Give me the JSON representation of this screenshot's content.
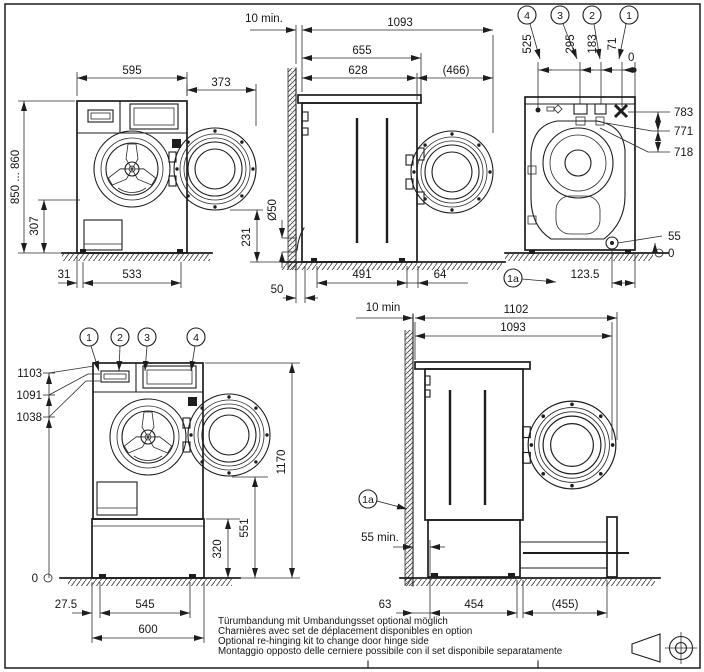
{
  "views": {
    "front_top": {
      "width": "595",
      "door_swing": "373",
      "height_range": "850 ... 860",
      "porthole_bottom": "307",
      "foot_inset": "31",
      "feet_distance": "533",
      "door_clearance": "231"
    },
    "side_top": {
      "wall_gap": "10 min.",
      "overall_depth": "1093",
      "lid_depth": "655",
      "body_depth": "628",
      "door_swing": "(466)",
      "drain_diameter": "Ø50",
      "rear_foot": "50",
      "feet_distance": "491",
      "front_overhang": "64"
    },
    "rear_top": {
      "callouts": [
        "4",
        "3",
        "2",
        "1"
      ],
      "conn_525": "525",
      "conn_295": "295",
      "conn_183": "183",
      "conn_71": "71",
      "datum_top": "0",
      "h_783": "783",
      "h_771": "771",
      "h_718": "718",
      "drain_height": "55",
      "datum_floor": "0",
      "drain_offset": "123.5",
      "detail_ref": "1a"
    },
    "front_bottom": {
      "callouts": [
        "1",
        "2",
        "3",
        "4"
      ],
      "conn_1103": "1103",
      "conn_1091": "1091",
      "conn_1038": "1038",
      "overall_height": "1170",
      "door_bottom": "551",
      "plinth_height": "320",
      "datum": "0",
      "edge_offset": "27.5",
      "feet_distance": "545",
      "plinth_width": "600"
    },
    "side_bottom": {
      "wall_gap": "10 min",
      "overall_depth": "1102",
      "body_depth": "1093",
      "detail_ref": "1a",
      "plinth_clearance": "55 min.",
      "rear_offset": "63",
      "feet_distance": "454",
      "drawer_extension": "(455)"
    }
  },
  "notes": [
    "Türumbandung mit Umbandungsset optional möglich",
    "Charnières avec set de déplacement disponibles en option",
    "Optional re-hinging kit to change door hinge side",
    "Montaggio opposto delle cerniere possibile con il set disponibile separatamente"
  ],
  "colors": {
    "line": "#1d1d1d",
    "background": "#ffffff"
  }
}
